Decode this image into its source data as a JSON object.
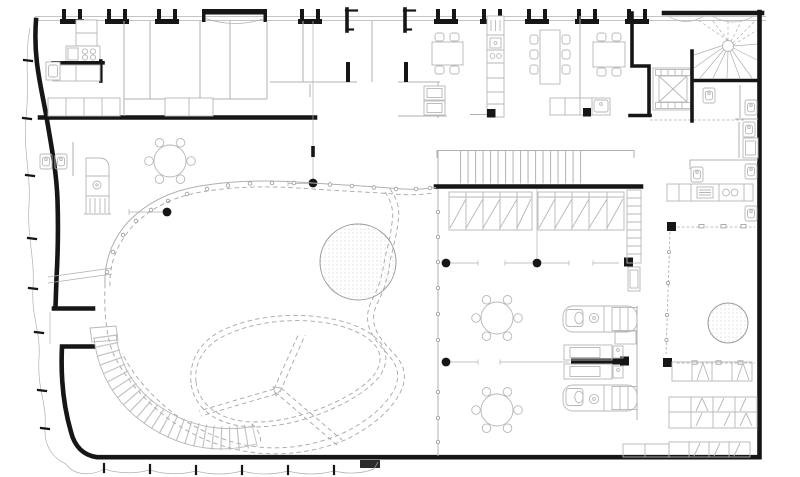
{
  "drawing": {
    "kind": "architectural floor plan",
    "visible_text": "",
    "colors": {
      "paper": "#ffffff",
      "ink": "#161616",
      "partition_gray": "#b0b0b0",
      "furniture_gray": "#b7b7b7",
      "dashed_gray": "#a6a6a6",
      "dot_pattern_gray": "#c2c2c2"
    },
    "elements": {
      "round_columns": 5,
      "square_columns": 4,
      "round_tables_with_chairs": 3,
      "rectangular_tables_with_chairs": 3,
      "elevator_shafts": 1,
      "straight_stairs": 1,
      "curved_stairs": 1,
      "winder_fan_stairs": 1,
      "dotted_skylight_circles": 2,
      "wc_fixtures": 11,
      "wc_pods": 3,
      "wardrobe_storage_banks": 2,
      "shelving_rows": 4,
      "kitchen_counters": 3,
      "dashed_void_outline": 1,
      "three_spoke_canopy": 1,
      "facade_piers": 9,
      "wavy_glass_facades": 2
    }
  }
}
